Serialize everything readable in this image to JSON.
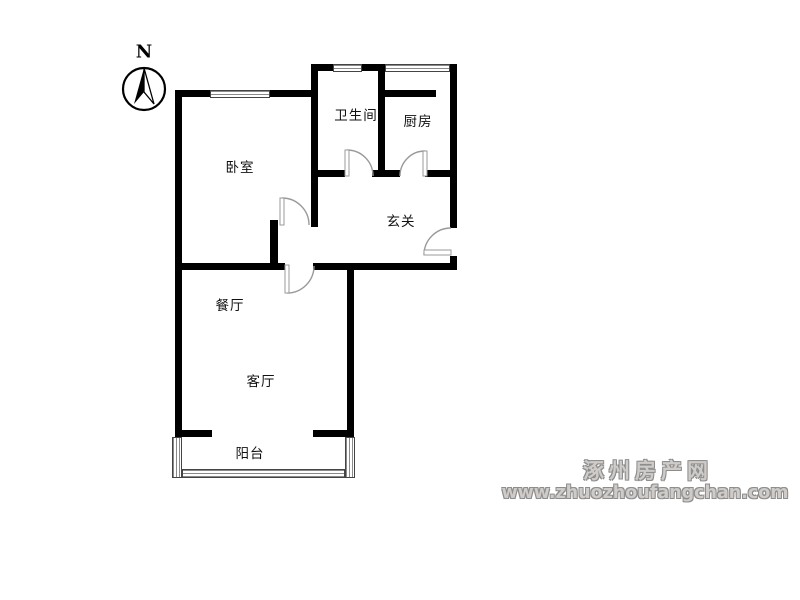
{
  "floorplan": {
    "compass_label": "N",
    "rooms": {
      "bedroom": {
        "label": "卧室"
      },
      "bathroom": {
        "label": "卫生间"
      },
      "kitchen": {
        "label": "厨房"
      },
      "entry": {
        "label": "玄关"
      },
      "dining": {
        "label": "餐厅"
      },
      "living": {
        "label": "客厅"
      },
      "balcony": {
        "label": "阳台"
      }
    }
  },
  "watermark": {
    "site_name": "涿州房产网",
    "site_url": "www.zhuozhoufangchan.com"
  },
  "colors": {
    "wall": "#000000",
    "door_arc": "#9a9a9a",
    "watermark_fill": "#cfcbc8",
    "watermark_outline": "#8d8d8d"
  }
}
